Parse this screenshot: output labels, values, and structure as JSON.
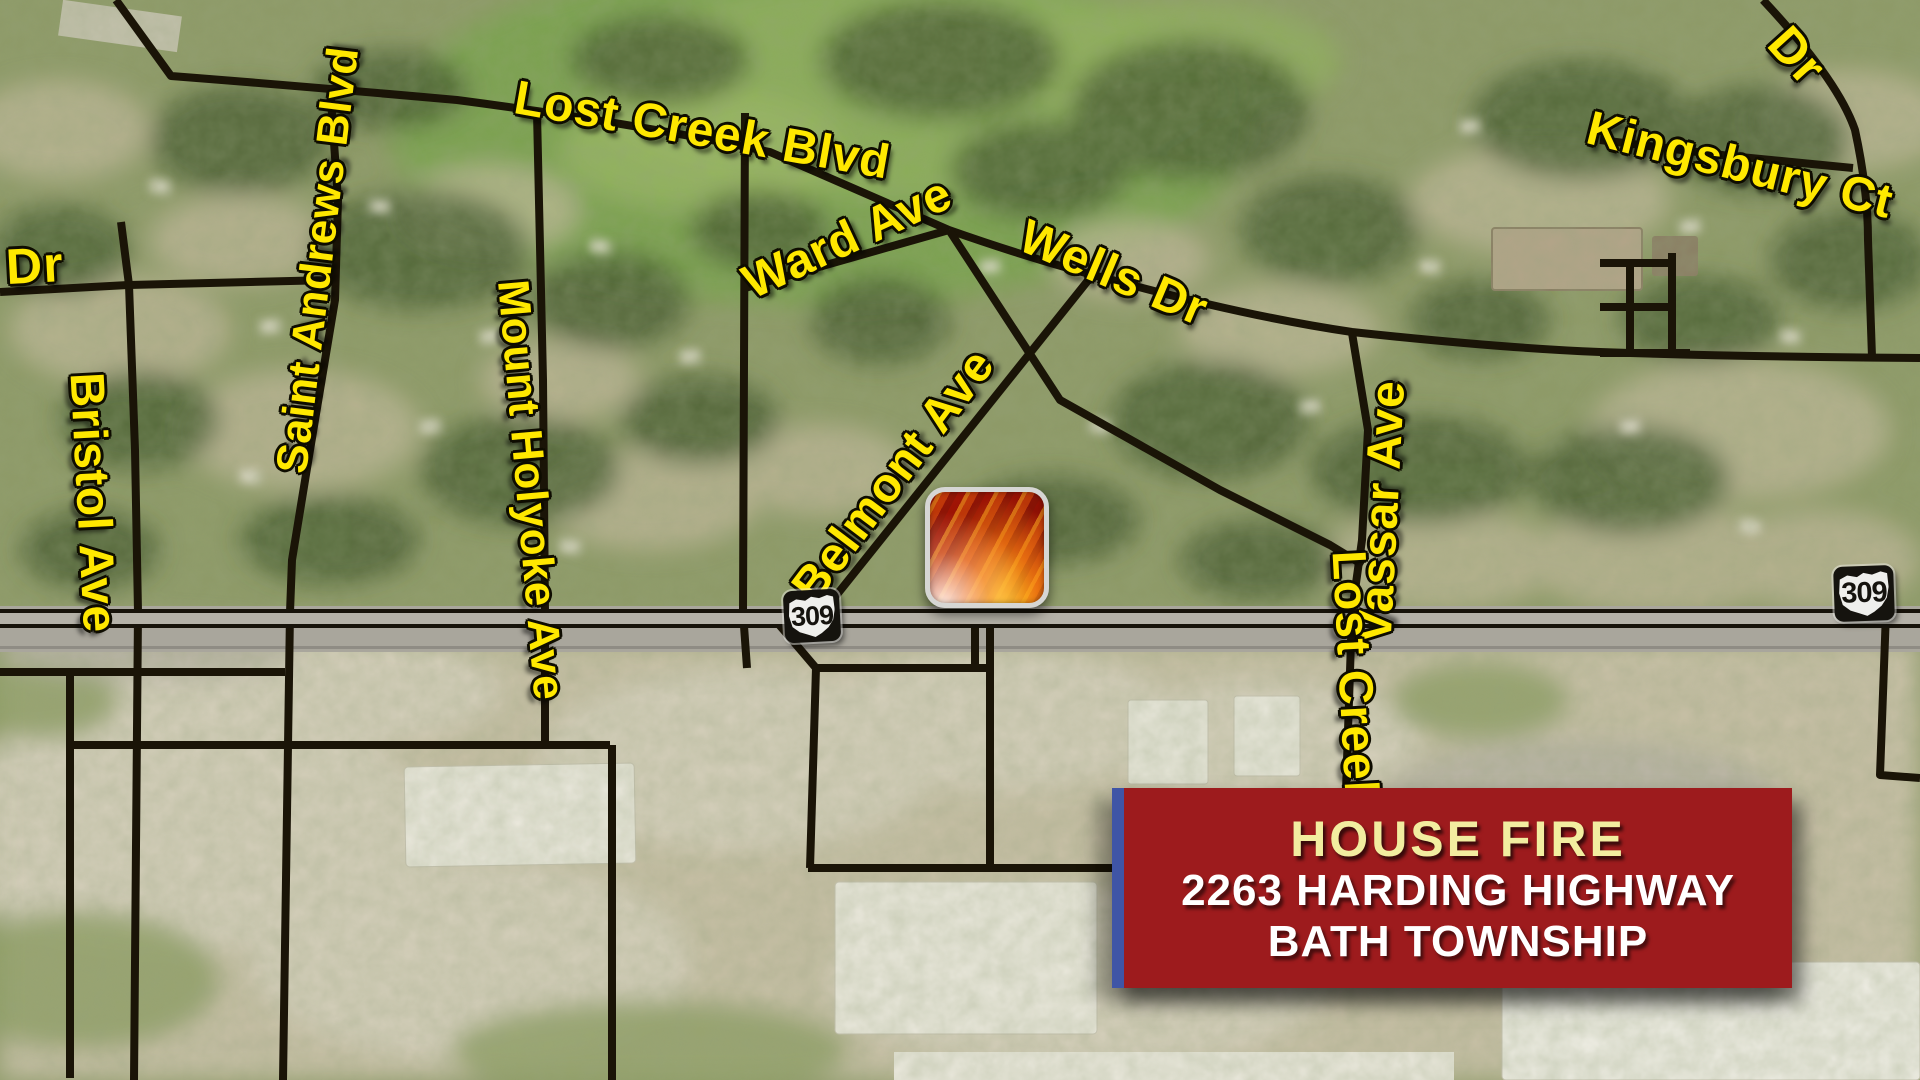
{
  "broadcast_map": {
    "alert_banner": {
      "title": "HOUSE FIRE",
      "address_line1": "2263 HARDING HIGHWAY",
      "address_line2": "BATH TOWNSHIP"
    },
    "route_shields": [
      {
        "number": "309"
      },
      {
        "number": "309"
      }
    ],
    "streets": [
      {
        "name": "Lost Creek Blvd"
      },
      {
        "name": "Kingsbury Ct"
      },
      {
        "name": "Dr"
      },
      {
        "name": "Dr"
      },
      {
        "name": "Saint Andrews Blvd"
      },
      {
        "name": "Mount Holyoke Ave"
      },
      {
        "name": "Bristol Ave"
      },
      {
        "name": "Ward Ave"
      },
      {
        "name": "Wells Dr"
      },
      {
        "name": "Belmont Ave"
      },
      {
        "name": "Vassar Ave"
      },
      {
        "name": "Lost Creek"
      }
    ],
    "colors": {
      "street_label_yellow": "#ffe800",
      "banner_red": "#9d1b1d",
      "banner_edge_blue": "#3f55a6",
      "banner_title_yellow": "#f2eda0",
      "road_black": "#1a1407"
    }
  }
}
